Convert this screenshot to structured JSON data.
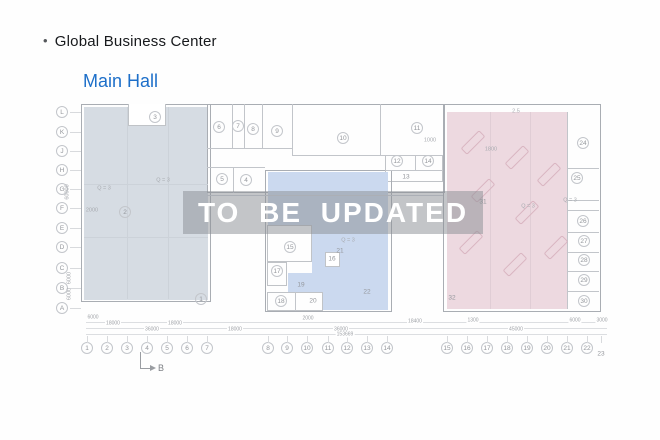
{
  "header": {
    "bullet": "•",
    "title": "Global Business Center"
  },
  "subtitle": "Main Hall",
  "watermark": "TO BE UPDATED",
  "section_marker": "B",
  "colors": {
    "subtitle_blue": "#1d6fc9",
    "left_hall_fill": "#d6dce3",
    "middle_hall_fill": "#cbd9ef",
    "right_hall_fill": "#edd9e0",
    "watermark_band": "#8c9096",
    "watermark_text": "#ffffff",
    "outline_gray": "#a9adb3"
  },
  "plan": {
    "axis_rows": [
      {
        "label": "L",
        "y": 112
      },
      {
        "label": "K",
        "y": 132
      },
      {
        "label": "J",
        "y": 151
      },
      {
        "label": "H",
        "y": 170
      },
      {
        "label": "G",
        "y": 189
      },
      {
        "label": "F",
        "y": 208
      },
      {
        "label": "E",
        "y": 228
      },
      {
        "label": "D",
        "y": 247
      },
      {
        "label": "C",
        "y": 268
      },
      {
        "label": "B",
        "y": 288
      },
      {
        "label": "A",
        "y": 308
      }
    ],
    "axis_cols": [
      {
        "label": "1",
        "x": 87
      },
      {
        "label": "2",
        "x": 107
      },
      {
        "label": "3",
        "x": 127
      },
      {
        "label": "4",
        "x": 147
      },
      {
        "label": "5",
        "x": 167
      },
      {
        "label": "6",
        "x": 187
      },
      {
        "label": "7",
        "x": 207
      },
      {
        "label": "8",
        "x": 268
      },
      {
        "label": "9",
        "x": 287
      },
      {
        "label": "10",
        "x": 307
      },
      {
        "label": "11",
        "x": 328
      },
      {
        "label": "12",
        "x": 347
      },
      {
        "label": "13",
        "x": 367
      },
      {
        "label": "14",
        "x": 387
      },
      {
        "label": "15",
        "x": 447
      },
      {
        "label": "16",
        "x": 467
      },
      {
        "label": "17",
        "x": 487
      },
      {
        "label": "18",
        "x": 507
      },
      {
        "label": "19",
        "x": 527
      },
      {
        "label": "20",
        "x": 547
      },
      {
        "label": "21",
        "x": 567
      },
      {
        "label": "22",
        "x": 587
      },
      {
        "label": "23",
        "x": 601,
        "circled": false,
        "dy": 6
      }
    ],
    "rooms": [
      {
        "n": "1",
        "x": 201,
        "y": 299
      },
      {
        "n": "2",
        "x": 125,
        "y": 212
      },
      {
        "n": "3",
        "x": 155,
        "y": 117
      },
      {
        "n": "4",
        "x": 246,
        "y": 180
      },
      {
        "n": "5",
        "x": 222,
        "y": 179
      },
      {
        "n": "6",
        "x": 219,
        "y": 127
      },
      {
        "n": "7",
        "x": 238,
        "y": 126
      },
      {
        "n": "8",
        "x": 253,
        "y": 129
      },
      {
        "n": "9",
        "x": 277,
        "y": 131
      },
      {
        "n": "10",
        "x": 343,
        "y": 138
      },
      {
        "n": "11",
        "x": 417,
        "y": 128
      },
      {
        "n": "12",
        "x": 397,
        "y": 161
      },
      {
        "n": "13",
        "x": 406,
        "y": 177,
        "circled": false
      },
      {
        "n": "14",
        "x": 428,
        "y": 161
      },
      {
        "n": "15",
        "x": 290,
        "y": 247
      },
      {
        "n": "16",
        "x": 332,
        "y": 259,
        "circled": false
      },
      {
        "n": "17",
        "x": 277,
        "y": 271
      },
      {
        "n": "18",
        "x": 281,
        "y": 301
      },
      {
        "n": "19",
        "x": 301,
        "y": 285,
        "circled": false
      },
      {
        "n": "20",
        "x": 313,
        "y": 301,
        "circled": false
      },
      {
        "n": "21",
        "x": 340,
        "y": 251,
        "circled": false
      },
      {
        "n": "22",
        "x": 367,
        "y": 292,
        "circled": false
      },
      {
        "n": "24",
        "x": 583,
        "y": 143
      },
      {
        "n": "25",
        "x": 577,
        "y": 178
      },
      {
        "n": "26",
        "x": 583,
        "y": 221
      },
      {
        "n": "27",
        "x": 584,
        "y": 241
      },
      {
        "n": "28",
        "x": 584,
        "y": 260
      },
      {
        "n": "29",
        "x": 584,
        "y": 280
      },
      {
        "n": "30",
        "x": 584,
        "y": 301
      },
      {
        "n": "31",
        "x": 483,
        "y": 202,
        "circled": false
      },
      {
        "n": "32",
        "x": 452,
        "y": 298,
        "circled": false
      }
    ],
    "notes": [
      {
        "text": "Q = 3",
        "x": 163,
        "y": 181
      },
      {
        "text": "Q = 3",
        "x": 104,
        "y": 189
      },
      {
        "text": "Q = 3",
        "x": 348,
        "y": 241
      },
      {
        "text": "Q = 3",
        "x": 528,
        "y": 207
      },
      {
        "text": "Q = 3",
        "x": 570,
        "y": 201
      },
      {
        "text": "2000",
        "x": 92,
        "y": 211
      },
      {
        "text": "1800",
        "x": 491,
        "y": 150
      },
      {
        "text": "1000",
        "x": 430,
        "y": 141
      },
      {
        "text": "2.5",
        "x": 516,
        "y": 112
      },
      {
        "text": "60000",
        "x": 68,
        "y": 192,
        "rot": -90
      },
      {
        "text": "6000",
        "x": 70,
        "y": 278,
        "rot": -90
      },
      {
        "text": "6000",
        "x": 70,
        "y": 294,
        "rot": -90
      }
    ],
    "dims": [
      {
        "text": "6000",
        "x": 93,
        "y": 318
      },
      {
        "text": "18000",
        "x": 113,
        "y": 324
      },
      {
        "text": "18000",
        "x": 175,
        "y": 324
      },
      {
        "text": "36000",
        "x": 152,
        "y": 330
      },
      {
        "text": "18000",
        "x": 235,
        "y": 330
      },
      {
        "text": "2000",
        "x": 308,
        "y": 319
      },
      {
        "text": "36000",
        "x": 341,
        "y": 330
      },
      {
        "text": "153669",
        "x": 345,
        "y": 335
      },
      {
        "text": "18400",
        "x": 415,
        "y": 322
      },
      {
        "text": "1300",
        "x": 473,
        "y": 321
      },
      {
        "text": "45000",
        "x": 516,
        "y": 330
      },
      {
        "text": "6000",
        "x": 575,
        "y": 321
      },
      {
        "text": "3000",
        "x": 602,
        "y": 321
      }
    ]
  }
}
